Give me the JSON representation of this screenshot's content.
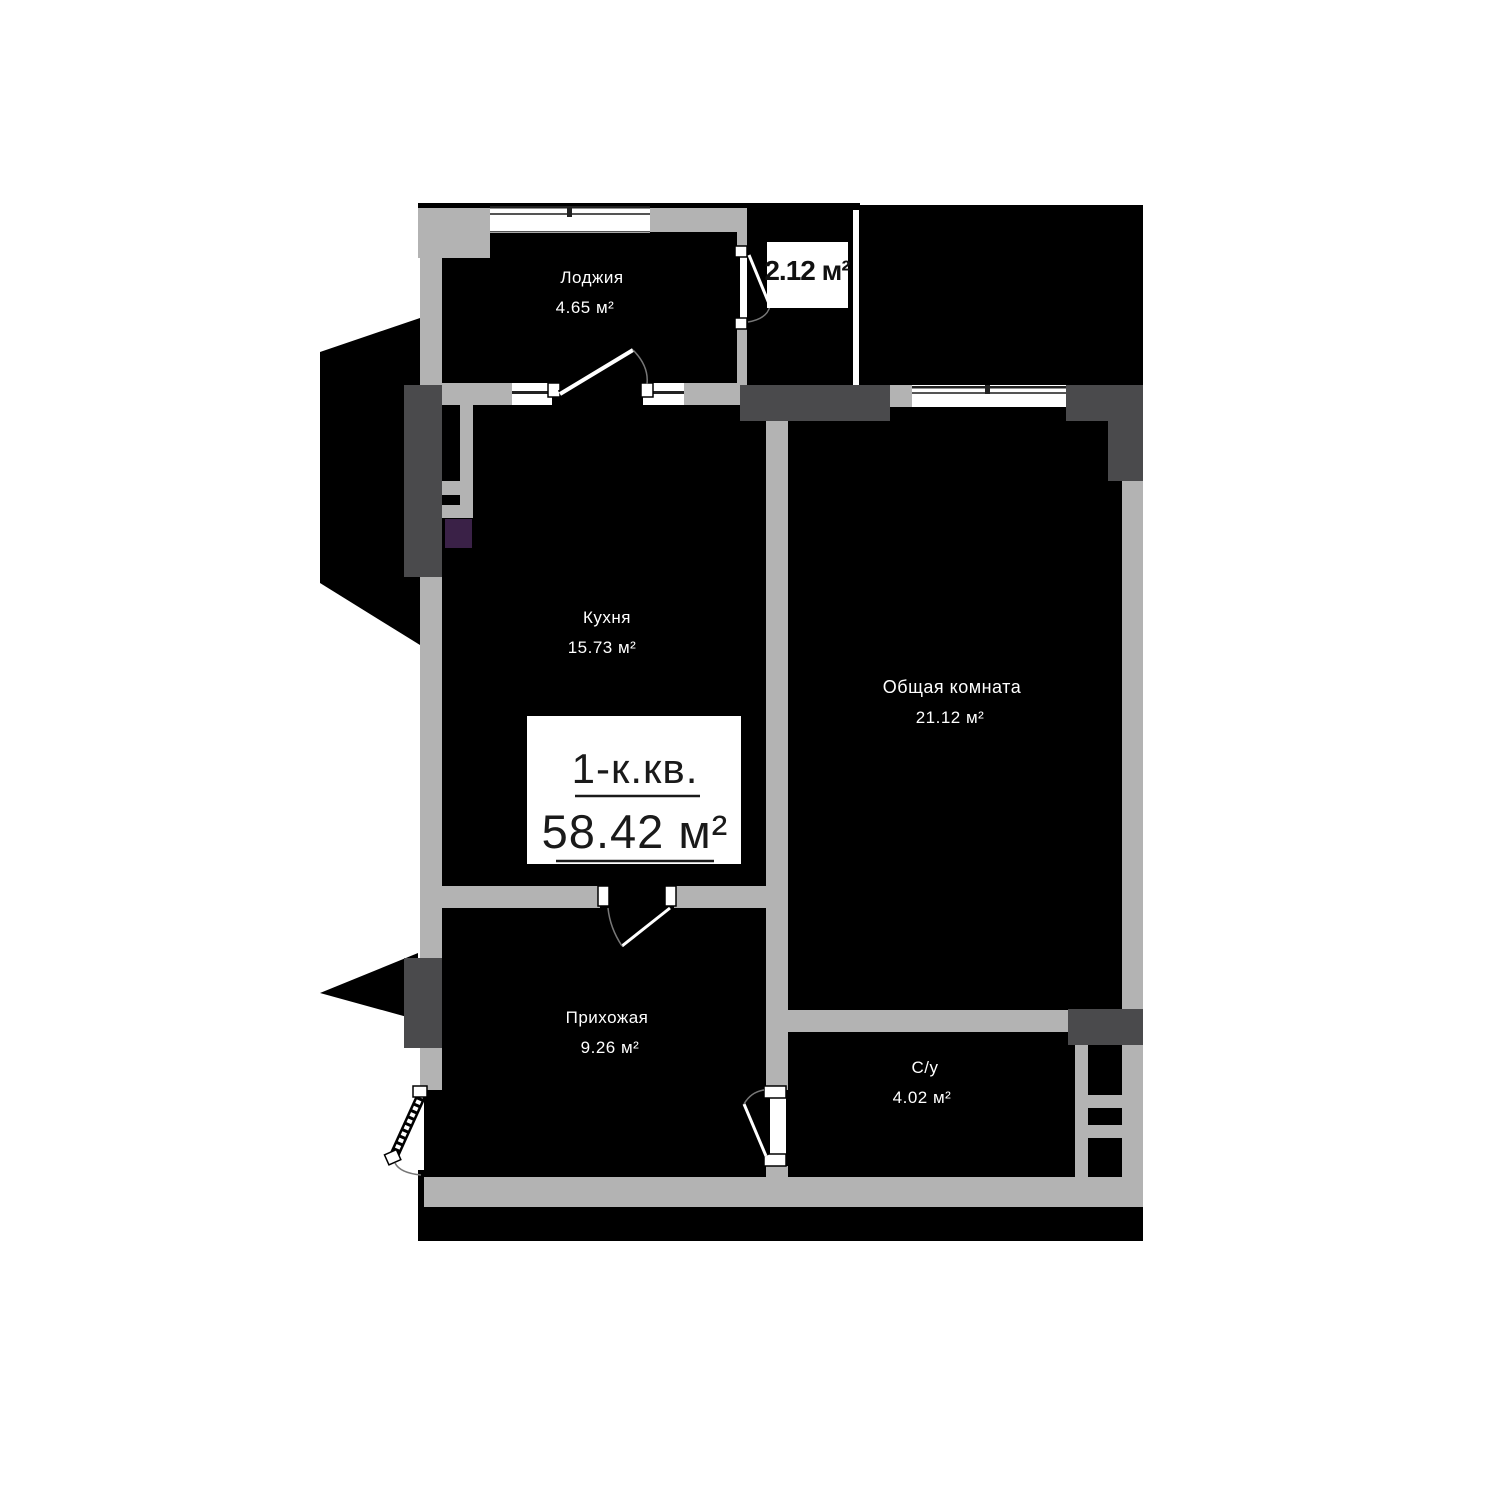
{
  "colors": {
    "background": "#ffffff",
    "room-fill": "#000000",
    "wall-light": "#b3b3b3",
    "wall-dark": "#4a4a4c",
    "accent-purple": "#3a2147",
    "label-text": "#ffffff",
    "title-text": "#1a1a1a"
  },
  "title_box": {
    "type": "1-к.кв.",
    "area": "58.42 м²"
  },
  "rooms": {
    "loggia": {
      "name": "Лоджия",
      "area": "4.65 м²"
    },
    "storage": {
      "area": "2.12 м²"
    },
    "kitchen": {
      "name": "Кухня",
      "area": "15.73 м²"
    },
    "living": {
      "name": "Общая комната",
      "area": "21.12 м²"
    },
    "hallway": {
      "name": "Прихожая",
      "area": "9.26 м²"
    },
    "bathroom": {
      "name": "С/у",
      "area": "4.02 м²"
    }
  }
}
